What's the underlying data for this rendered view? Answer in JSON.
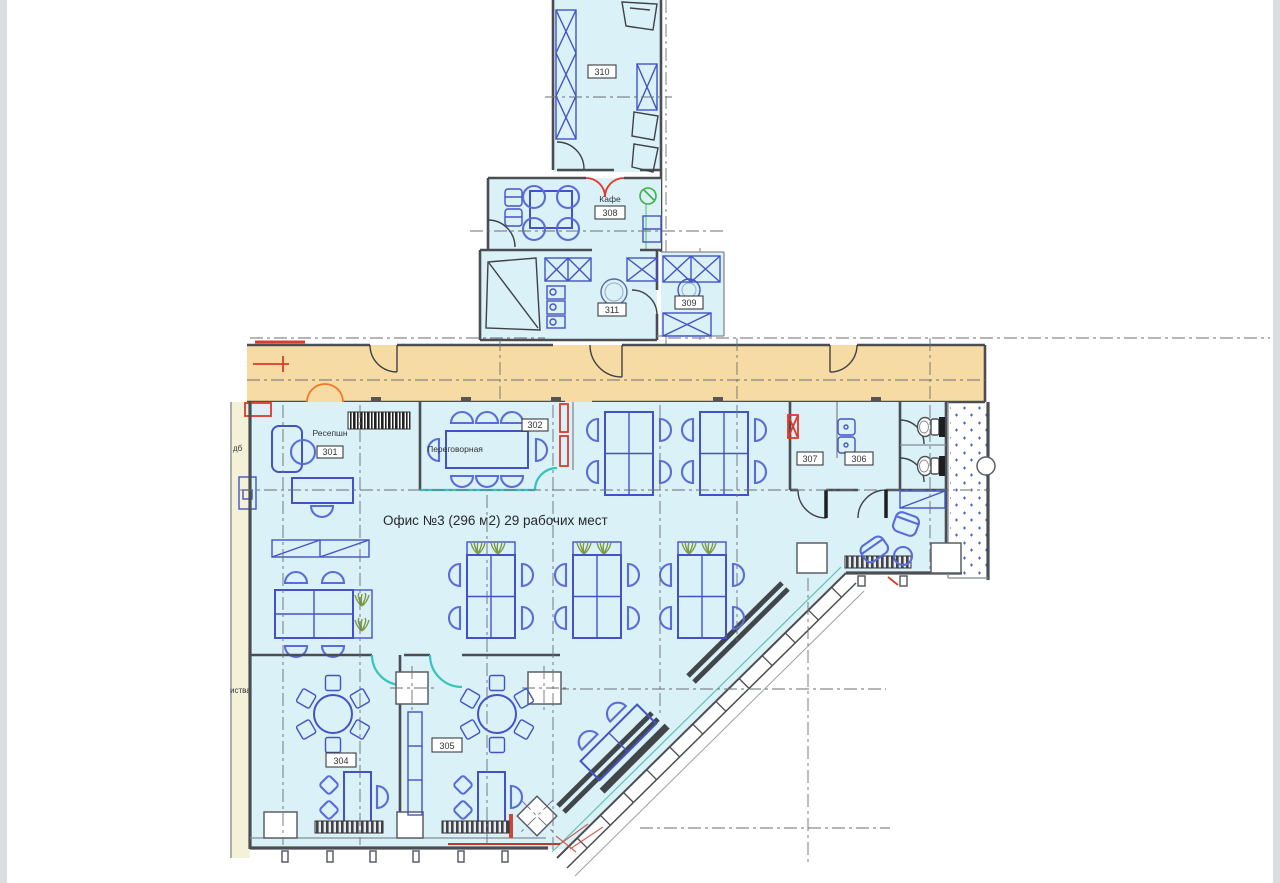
{
  "meta": {
    "kind": "architectural-floor-plan",
    "language": "ru"
  },
  "labels": {
    "room310": "310",
    "cafe": "Кафе",
    "room308": "308",
    "room311": "311",
    "room309": "309",
    "reception": "Ресепшн",
    "room301": "301",
    "meeting": "Переговорная",
    "room302": "302",
    "room307": "307",
    "room306": "306",
    "room304": "304",
    "room305": "305",
    "officeTitle": "Офис №3 (296 м2) 29 рабочих мест",
    "edgeFragmentTop": "дб",
    "edgeFragmentBottom": "иства"
  },
  "palette": {
    "roomFill": "#d9f1f7",
    "corridorFill": "#f7dba4",
    "exteriorStrip": "#f4f1d8",
    "furnitureBlue": "#4353c6",
    "wallGray": "#4a4e52",
    "accentRed": "#e0392b",
    "accentOrange": "#f07822",
    "accentTeal": "#35c4bc",
    "accentGreen": "#3fae4c",
    "plantGreen": "#7d9b42"
  }
}
